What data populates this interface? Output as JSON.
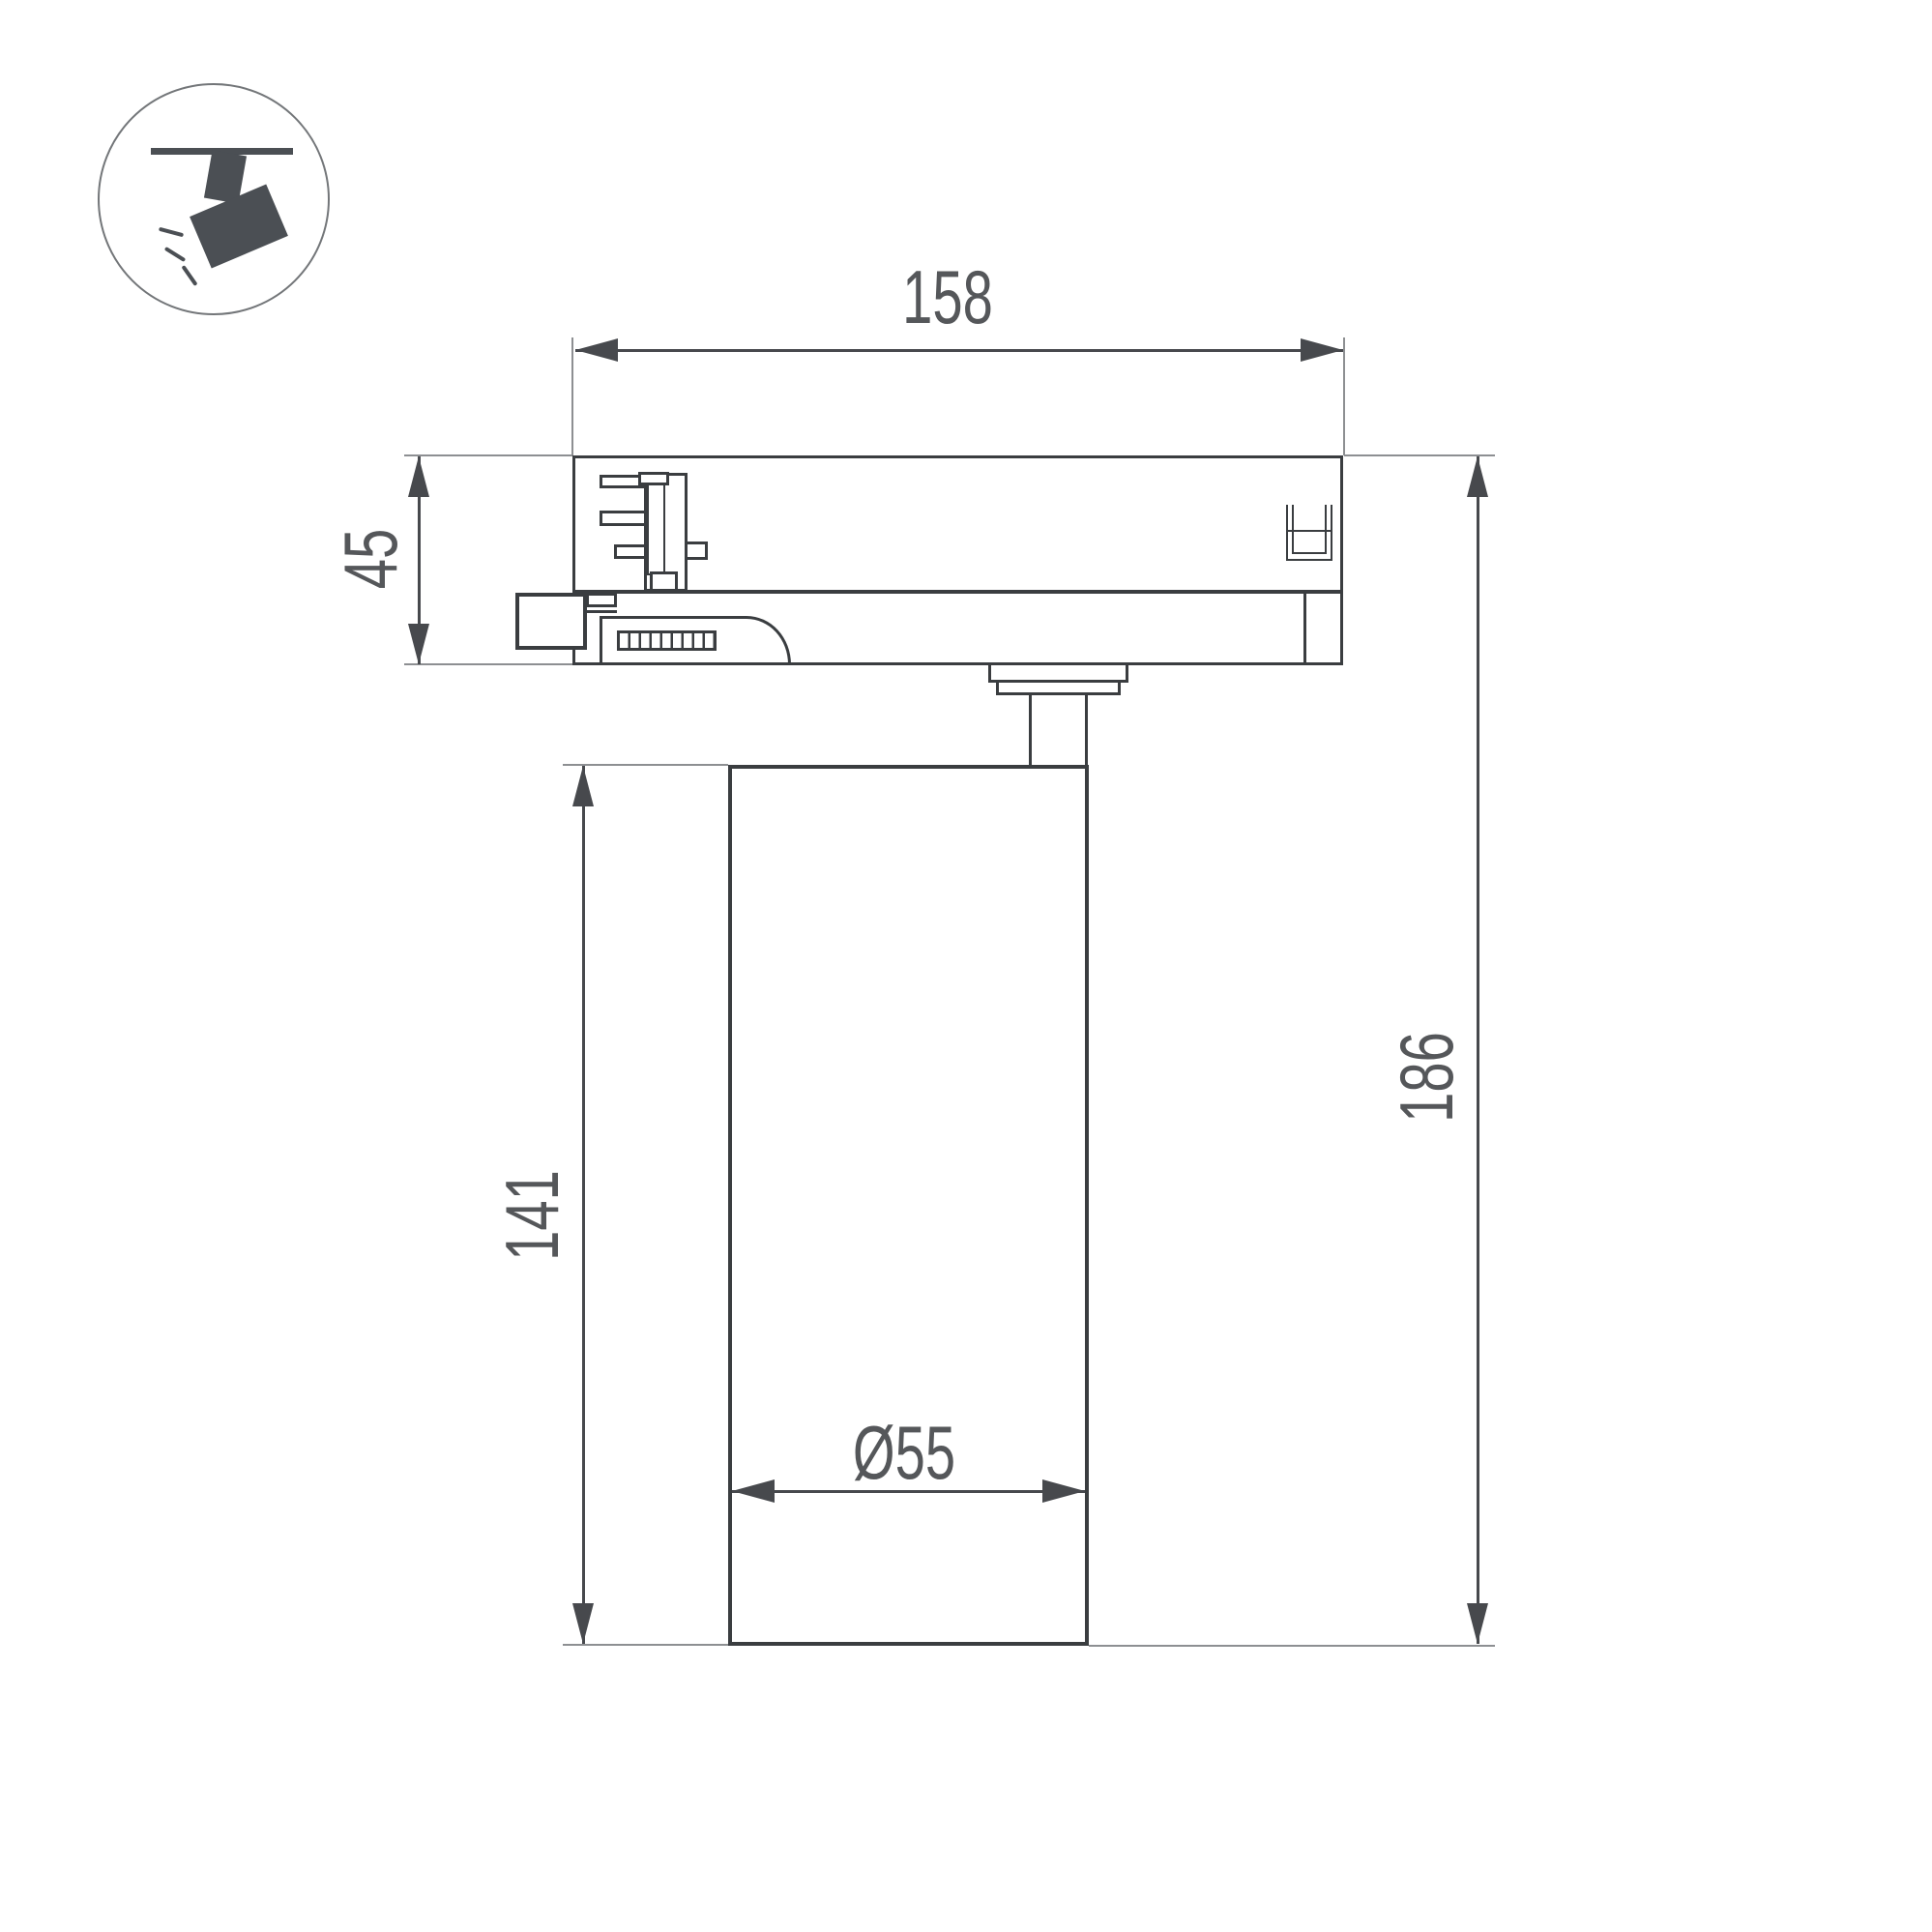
{
  "document": {
    "type": "technical-dimension-drawing",
    "subject": "track-mounted spotlight luminaire, side section view"
  },
  "icon": {
    "name": "track-spotlight-pictogram",
    "parts": [
      "ceiling-track-line",
      "track-stem",
      "tilted-spotlight-body",
      "light-rays"
    ]
  },
  "dimensions": {
    "adapter_width": "158",
    "adapter_height": "45",
    "body_height": "141",
    "total_height": "186",
    "body_diameter": "Ø55"
  },
  "colors": {
    "outline": "#3a3d40",
    "dimension_line": "#47494d",
    "extension_line": "#8d8f92",
    "label_text": "#55575a",
    "icon_fill": "#4b4f54",
    "icon_ring": "#737679",
    "background": "#ffffff"
  }
}
